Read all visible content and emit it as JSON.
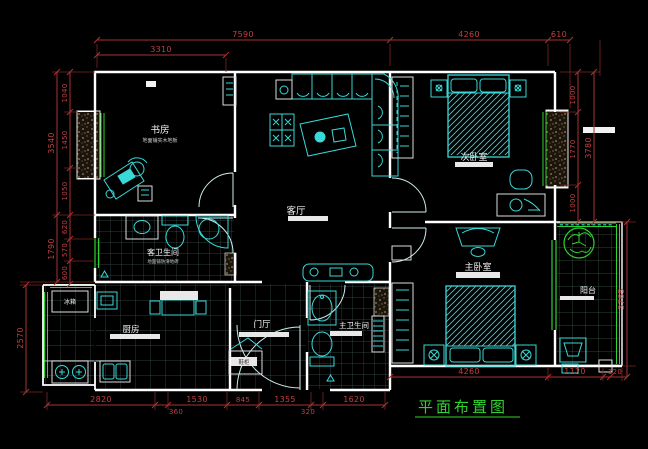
{
  "title": {
    "text": "平面布置图"
  },
  "rooms": {
    "study": {
      "name": "书房",
      "note": "地面铺实木地板"
    },
    "living": {
      "name": "客厅"
    },
    "bedroom2": {
      "name": "次卧室"
    },
    "master_bedroom": {
      "name": "主卧室"
    },
    "guest_bath": {
      "name": "客卫生间",
      "note": "地面铺防滑地砖"
    },
    "kitchen": {
      "name": "厨房"
    },
    "entry": {
      "name": "门厅"
    },
    "master_bath": {
      "name": "主卫生间"
    },
    "balcony": {
      "name": "阳台"
    }
  },
  "furniture_labels": {
    "fridge": "冰箱",
    "shoe_cabinet": "鞋柜"
  },
  "dims": {
    "top": [
      "7590",
      "3310",
      "4260",
      "610"
    ],
    "left": [
      "3540",
      "1790",
      "2570",
      "1040",
      "1450",
      "1050",
      "620",
      "570",
      "600"
    ],
    "right": [
      "1000",
      "1770",
      "1000",
      "3780",
      "3765"
    ],
    "bottom": [
      "2820",
      "360",
      "1530",
      "845",
      "1355",
      "320",
      "1620",
      "4260",
      "1120",
      "120"
    ]
  },
  "colors": {
    "background": "#000000",
    "wall": "#ffffff",
    "furniture": "#38d9d9",
    "dimension": "#b03232",
    "green": "#2fd32f",
    "window_hatch": "#96835e"
  }
}
